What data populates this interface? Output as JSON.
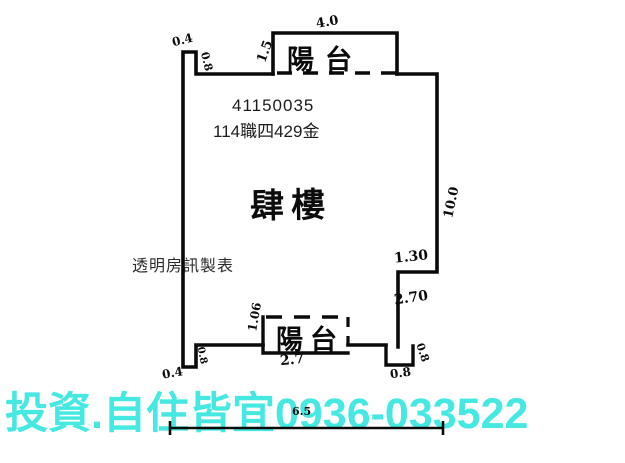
{
  "labels": {
    "id_number": "41150035",
    "case_number": "114職四429金",
    "floor_name": "肆樓",
    "maker_watermark": "透明房訊製表",
    "balcony": "陽台",
    "ad_text": "投資.自住皆宜0936-033522"
  },
  "dims": {
    "top_balcony_width": "4.0",
    "top_balcony_depth": "1.5",
    "tl_notch_width": "0.4",
    "tl_notch_depth": "0.8",
    "right_wall_height": "10.0",
    "right_step_width": "1.30",
    "right_step_height": "2.70",
    "br_corner_side": "0.8",
    "br_corner_bottom": "0.8",
    "bl_step_width": "0.4",
    "bl_step_depth": "0.8",
    "bottom_balcony_width": "2.7",
    "bottom_balcony_depth": "1.06",
    "bottom_overall": "6.5"
  },
  "colors": {
    "ad_text": "#46E8E2",
    "line": "#0a0a0a"
  }
}
